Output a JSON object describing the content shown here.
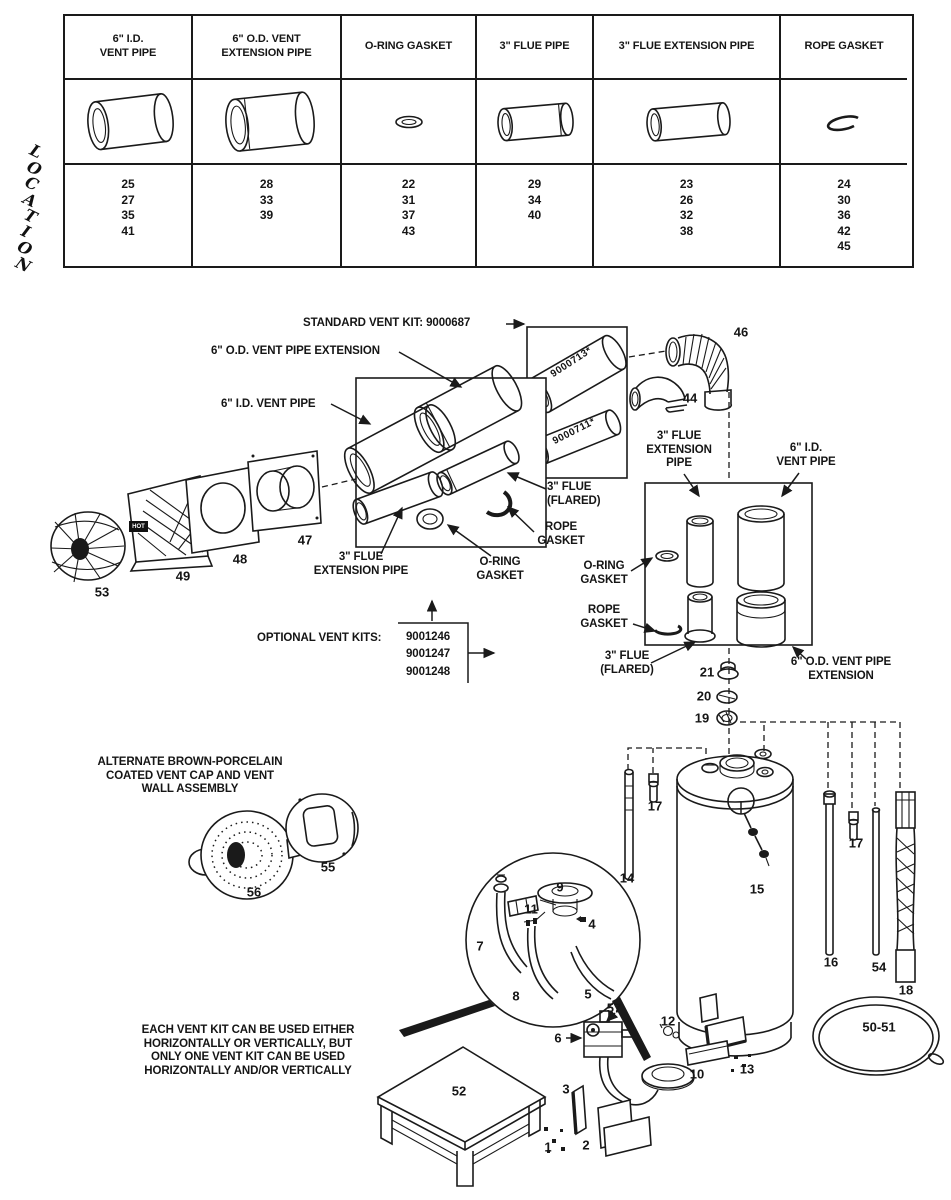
{
  "location_label": "LOCATION",
  "parts_table": {
    "columns": [
      {
        "label": "6\" I.D.\nVENT PIPE",
        "locations": "25\n27\n35\n41"
      },
      {
        "label": "6\" O.D. VENT\nEXTENSION PIPE",
        "locations": "28\n33\n39"
      },
      {
        "label": "O-RING GASKET",
        "locations": "22\n31\n37\n43"
      },
      {
        "label": "3\" FLUE PIPE",
        "locations": "29\n34\n40"
      },
      {
        "label": "3\" FLUE EXTENSION PIPE",
        "locations": "23\n26\n32\n38"
      },
      {
        "label": "ROPE GASKET",
        "locations": "24\n30\n36\n42\n45"
      }
    ]
  },
  "labels": {
    "standard_kit": "STANDARD VENT KIT: 9000687",
    "od_vent_ext": "6\" O.D. VENT PIPE EXTENSION",
    "id_vent_pipe": "6\" I.D. VENT PIPE",
    "flue_flared": "3\" FLUE\n(FLARED)",
    "rope_gasket": "ROPE\nGASKET",
    "flue_ext_two_line": "3\" FLUE\nEXTENSION PIPE",
    "oring_gasket": "O-RING\nGASKET",
    "optional_kits": "OPTIONAL VENT KITS:",
    "optional_kit_numbers": "9001246\n9001247\n9001248",
    "flue_ext_three_line": "3\" FLUE\nEXTENSION\nPIPE",
    "id_vent_two_line": "6\" I.D.\nVENT PIPE",
    "od_ext_two_line": "6\" O.D. VENT PIPE\nEXTENSION",
    "alternate_cap": "ALTERNATE BROWN-PORCELAIN\nCOATED VENT CAP AND VENT\nWALL ASSEMBLY",
    "usage_note": "EACH VENT KIT CAN BE USED EITHER\nHORIZONTALLY OR VERTICALLY, BUT\nONLY ONE VENT KIT CAN BE USED\nHORIZONTALLY AND/OR VERTICALLY",
    "pipe_marking_top": "9000713*",
    "pipe_marking_bottom": "9000711*",
    "hot_label": "HOT"
  },
  "items": {
    "n1": "1",
    "n2": "2",
    "n3": "3",
    "n4": "4",
    "n5": "5",
    "n6": "6",
    "n7": "7",
    "n8": "8",
    "n9": "9",
    "n10": "10",
    "n11": "11",
    "n12": "12",
    "n13": "13",
    "n14": "14",
    "n15": "15",
    "n16": "16",
    "n17a": "17",
    "n17b": "17",
    "n18": "18",
    "n19": "19",
    "n20": "20",
    "n21": "21",
    "n44": "44",
    "n46": "46",
    "n47": "47",
    "n48": "48",
    "n49": "49",
    "n50_51": "50-51",
    "n52": "52",
    "n53": "53",
    "n54": "54",
    "n55": "55",
    "n56": "56",
    "n57": "57"
  }
}
